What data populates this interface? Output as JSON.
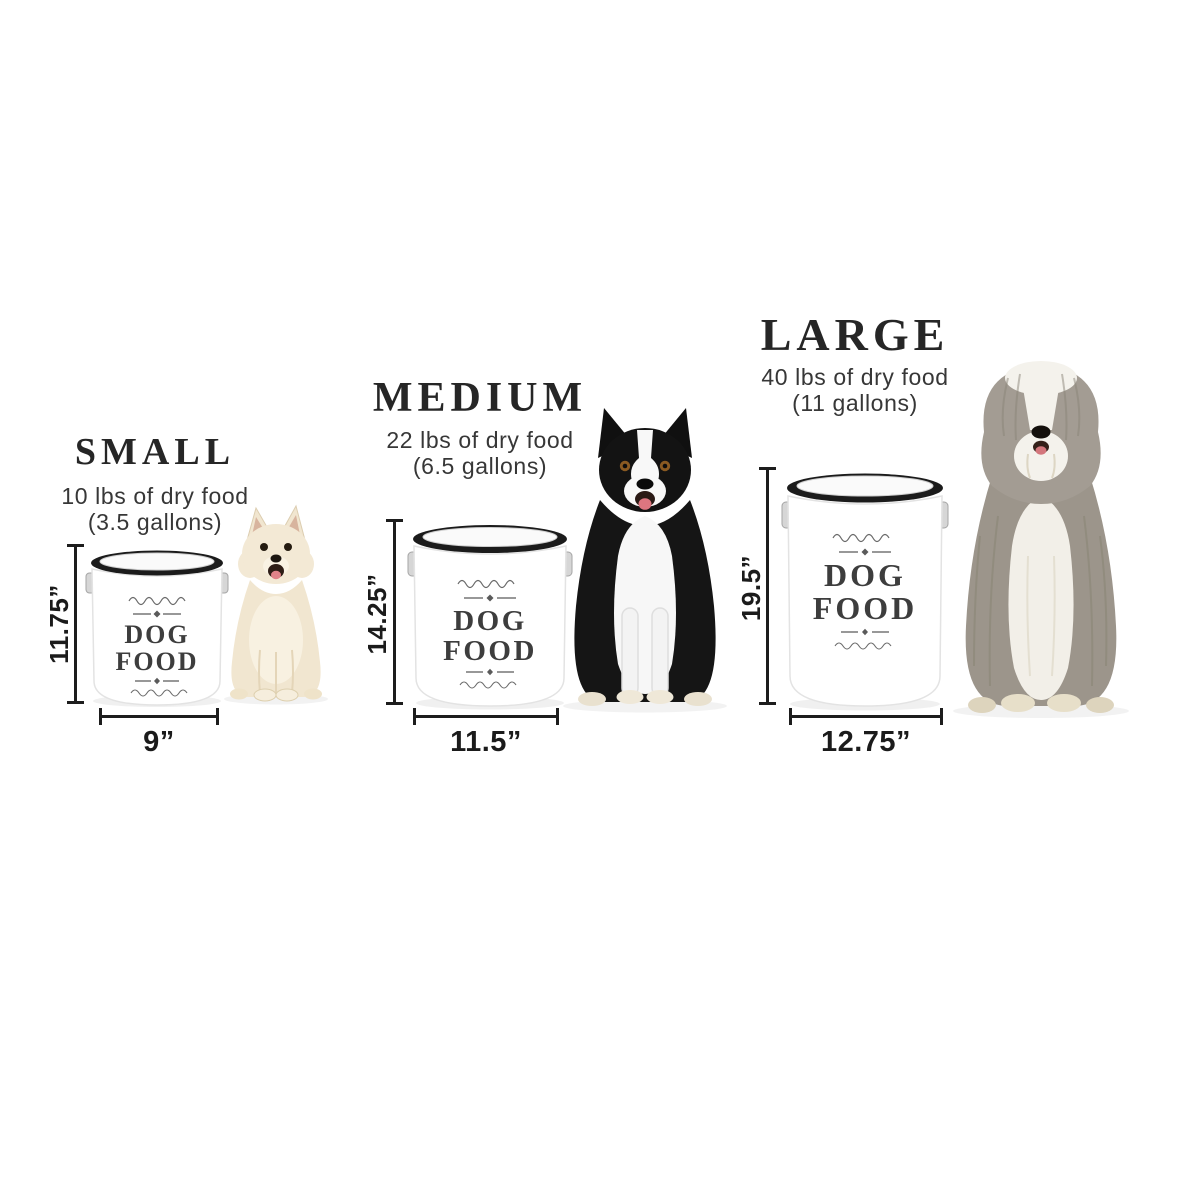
{
  "diagram_title": "Dog food canister size comparison",
  "canister_label": {
    "line1": "DOG",
    "line2": "FOOD"
  },
  "sizes": [
    {
      "name": "small",
      "title": "SMALL",
      "capacity": "10 lbs of dry food",
      "volume": "(3.5 gallons)",
      "height": "11.75”",
      "width": "9”",
      "dog": "cream long-haired chihuahua sitting"
    },
    {
      "name": "medium",
      "title": "MEDIUM",
      "capacity": "22 lbs of dry food",
      "volume": "(6.5 gallons)",
      "height": "14.25”",
      "width": "11.5”",
      "dog": "black and white border collie sitting"
    },
    {
      "name": "large",
      "title": "LARGE",
      "capacity": "40 lbs of dry food",
      "volume": "(11 gallons)",
      "height": "19.5”",
      "width": "12.75”",
      "dog": "grey and white bearded collie sitting"
    }
  ],
  "colors": {
    "background": "#ffffff",
    "text": "#262626",
    "dimension_lines": "#1d1d1d",
    "canister_body": "#ffffff",
    "canister_lid": "#1b1b1b",
    "canister_label_text": "#3d3d3d"
  }
}
